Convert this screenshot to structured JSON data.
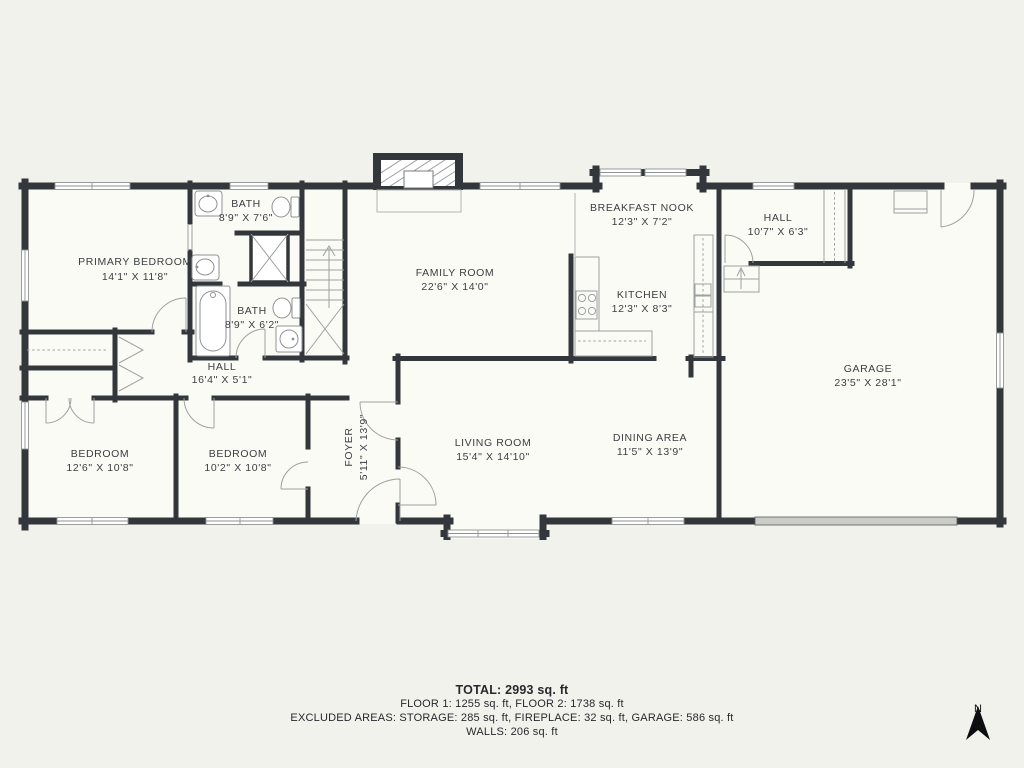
{
  "palette": {
    "background": "#f2f2ec",
    "floor": "#fbfbf6",
    "wall": "#33373b",
    "fixture": "#8f9294",
    "label": "#3b3e42",
    "footer": "#26292d"
  },
  "rooms": [
    {
      "id": "primary-bedroom",
      "name": "PRIMARY BEDROOM",
      "dims": "14'1\" X 11'8\""
    },
    {
      "id": "bath-top",
      "name": "BATH",
      "dims": "8'9\" X 7'6\""
    },
    {
      "id": "bath-bottom",
      "name": "BATH",
      "dims": "8'9\" X 6'2\""
    },
    {
      "id": "hall-left",
      "name": "HALL",
      "dims": "16'4\" X 5'1\""
    },
    {
      "id": "bedroom-left",
      "name": "BEDROOM",
      "dims": "12'6\" X 10'8\""
    },
    {
      "id": "bedroom-middle",
      "name": "BEDROOM",
      "dims": "10'2\" X 10'8\""
    },
    {
      "id": "foyer",
      "name": "FOYER",
      "dims": "5'11\" X 13'9\""
    },
    {
      "id": "family-room",
      "name": "FAMILY ROOM",
      "dims": "22'6\" X 14'0\""
    },
    {
      "id": "living-room",
      "name": "LIVING ROOM",
      "dims": "15'4\" X 14'10\""
    },
    {
      "id": "dining-area",
      "name": "DINING AREA",
      "dims": "11'5\" X 13'9\""
    },
    {
      "id": "breakfast-nook",
      "name": "BREAKFAST NOOK",
      "dims": "12'3\" X 7'2\""
    },
    {
      "id": "kitchen",
      "name": "KITCHEN",
      "dims": "12'3\" X 8'3\""
    },
    {
      "id": "hall-right",
      "name": "HALL",
      "dims": "10'7\" X 6'3\""
    },
    {
      "id": "garage",
      "name": "GARAGE",
      "dims": "23'5\" X 28'1\""
    }
  ],
  "summary": {
    "total": "TOTAL: 2993 sq. ft",
    "floors": "FLOOR 1: 1255 sq. ft, FLOOR 2: 1738 sq. ft",
    "excluded": "EXCLUDED AREAS: STORAGE: 285 sq. ft, FIREPLACE: 32 sq. ft, GARAGE: 586 sq. ft",
    "walls": "WALLS: 206 sq. ft"
  },
  "compass": {
    "label": "N"
  }
}
